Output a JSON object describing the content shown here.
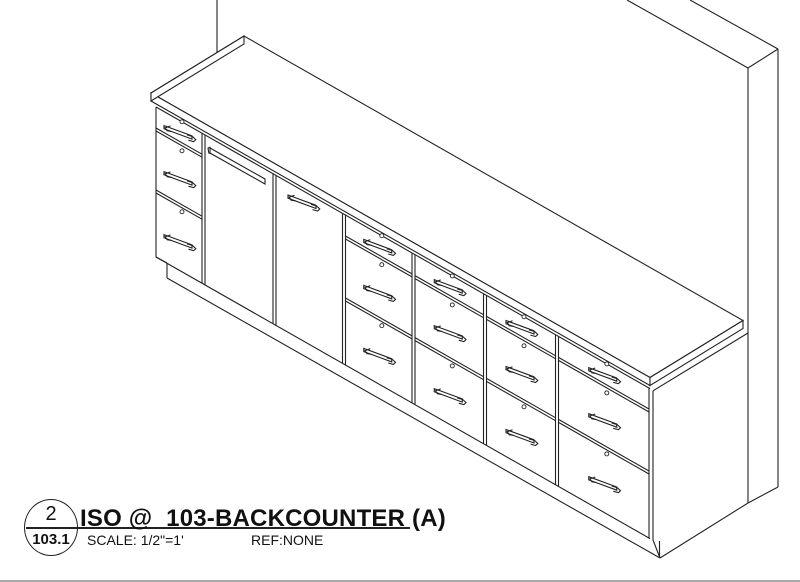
{
  "figure": {
    "type": "isometric CAD drawing",
    "subject": "backcounter casework: wall panel, countertop, two doors and five three-drawer banks with bar pulls and toe kick"
  },
  "title_block": {
    "detail_number": "2",
    "sheet_number": "103.1",
    "title": "ISO @  103-BACKCOUNTER (A)",
    "scale": "SCALE: 1/2\"=1'",
    "reference": "REF:NONE"
  },
  "colors": {
    "background": "#ffffff",
    "line": "#222222",
    "footer_rule": "#a8a8a8"
  }
}
